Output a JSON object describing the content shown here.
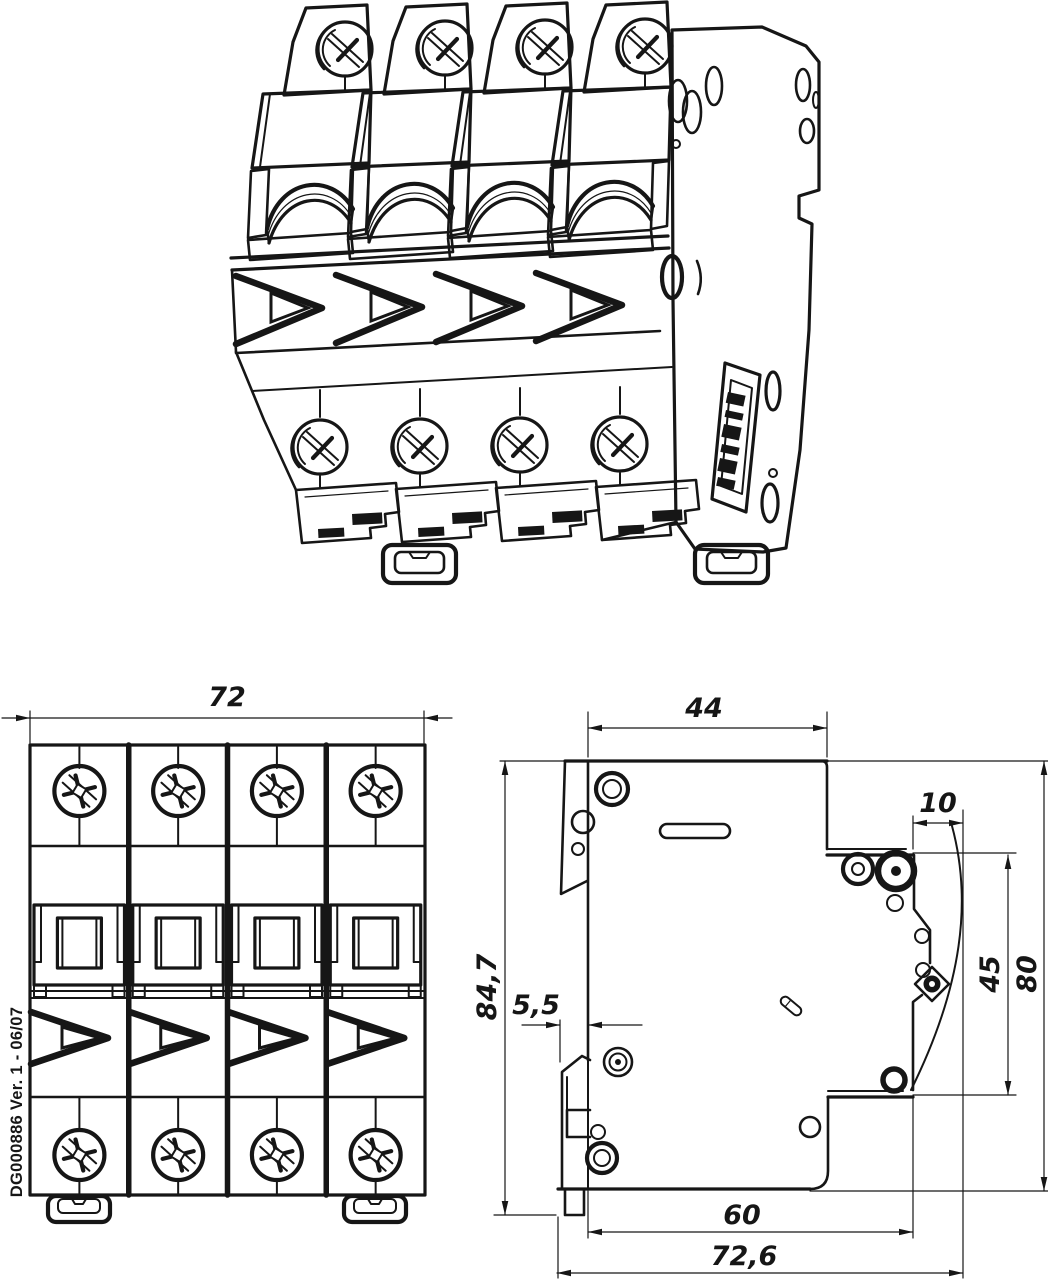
{
  "drawing": {
    "background": "#ffffff",
    "ink": "#161616",
    "doc_number": "DG000886 Ver. 1 - 06/07",
    "front_view": {
      "dim_width": "72"
    },
    "side_view": {
      "dim_depth_top": "44",
      "dim_recess_depth": "10",
      "dim_height_total": "84,7",
      "dim_din_depth": "5,5",
      "dim_terminal_height": "45",
      "dim_height_front": "80",
      "dim_depth_lower": "60",
      "dim_depth_total": "72,6"
    }
  }
}
